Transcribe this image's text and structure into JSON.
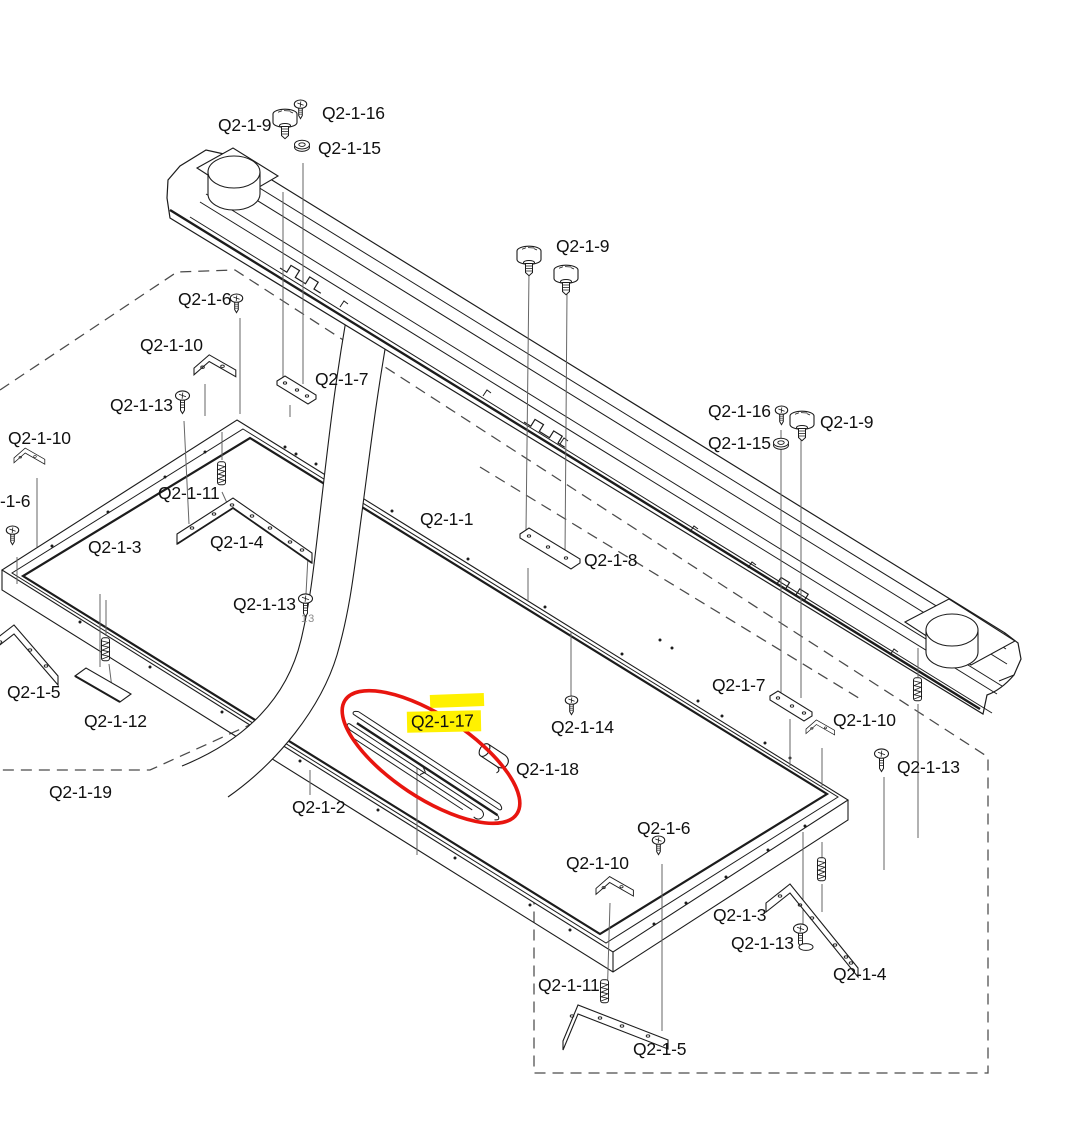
{
  "diagram": {
    "type": "exploded-parts-assembly-drawing",
    "description": "Isometric exploded view of a sewing-machine table frame and guide rail assembly with part callouts",
    "annotations": {
      "highlighted_part": "Q2-1-17",
      "highlight_color": "#fff100",
      "circle_marker_color": "#e8150f",
      "stray_note": "13"
    },
    "labels": [
      {
        "text": "Q2-1-9",
        "x": 218,
        "y": 116
      },
      {
        "text": "Q2-1-16",
        "x": 322,
        "y": 104
      },
      {
        "text": "Q2-1-15",
        "x": 318,
        "y": 139
      },
      {
        "text": "Q2-1-6",
        "x": 178,
        "y": 290
      },
      {
        "text": "Q2-1-10",
        "x": 140,
        "y": 336
      },
      {
        "text": "Q2-1-13",
        "x": 110,
        "y": 396
      },
      {
        "text": "Q2-1-7",
        "x": 315,
        "y": 370
      },
      {
        "text": "Q2-1-10",
        "x": 8,
        "y": 429
      },
      {
        "text": "-1-6",
        "x": 0,
        "y": 492
      },
      {
        "text": "Q2-1-11",
        "x": 158,
        "y": 484
      },
      {
        "text": "Q2-1-3",
        "x": 88,
        "y": 538
      },
      {
        "text": "Q2-1-4",
        "x": 210,
        "y": 533
      },
      {
        "text": "Q2-1-13",
        "x": 233,
        "y": 595
      },
      {
        "text": "13",
        "x": 301,
        "y": 614,
        "style": "sm"
      },
      {
        "text": "Q2-1-5",
        "x": 7,
        "y": 683
      },
      {
        "text": "Q2-1-12",
        "x": 84,
        "y": 712
      },
      {
        "text": "Q2-1-19",
        "x": 49,
        "y": 783
      },
      {
        "text": "Q2-1-2",
        "x": 292,
        "y": 798
      },
      {
        "text": "Q2-1-1",
        "x": 420,
        "y": 510
      },
      {
        "text": "Q2-1-9",
        "x": 556,
        "y": 237
      },
      {
        "text": "Q2-1-8",
        "x": 584,
        "y": 551
      },
      {
        "text": "Q2-1-14",
        "x": 551,
        "y": 718
      },
      {
        "text": "Q2-1-17",
        "x": 407,
        "y": 711,
        "style": "hl"
      },
      {
        "text": "Q2-1-18",
        "x": 516,
        "y": 760
      },
      {
        "text": "Q2-1-16",
        "x": 708,
        "y": 402
      },
      {
        "text": "Q2-1-9",
        "x": 820,
        "y": 413
      },
      {
        "text": "Q2-1-15",
        "x": 708,
        "y": 434
      },
      {
        "text": "Q2-1-7",
        "x": 712,
        "y": 676
      },
      {
        "text": "Q2-1-10",
        "x": 833,
        "y": 711
      },
      {
        "text": "Q2-1-13",
        "x": 897,
        "y": 758
      },
      {
        "text": "Q2-1-6",
        "x": 637,
        "y": 819
      },
      {
        "text": "Q2-1-10",
        "x": 566,
        "y": 854
      },
      {
        "text": "Q2-1-3",
        "x": 713,
        "y": 906
      },
      {
        "text": "Q2-1-13",
        "x": 731,
        "y": 934
      },
      {
        "text": "Q2-1-4",
        "x": 833,
        "y": 965
      },
      {
        "text": "Q2-1-11",
        "x": 538,
        "y": 976
      },
      {
        "text": "Q2-1-5",
        "x": 633,
        "y": 1040
      }
    ]
  }
}
